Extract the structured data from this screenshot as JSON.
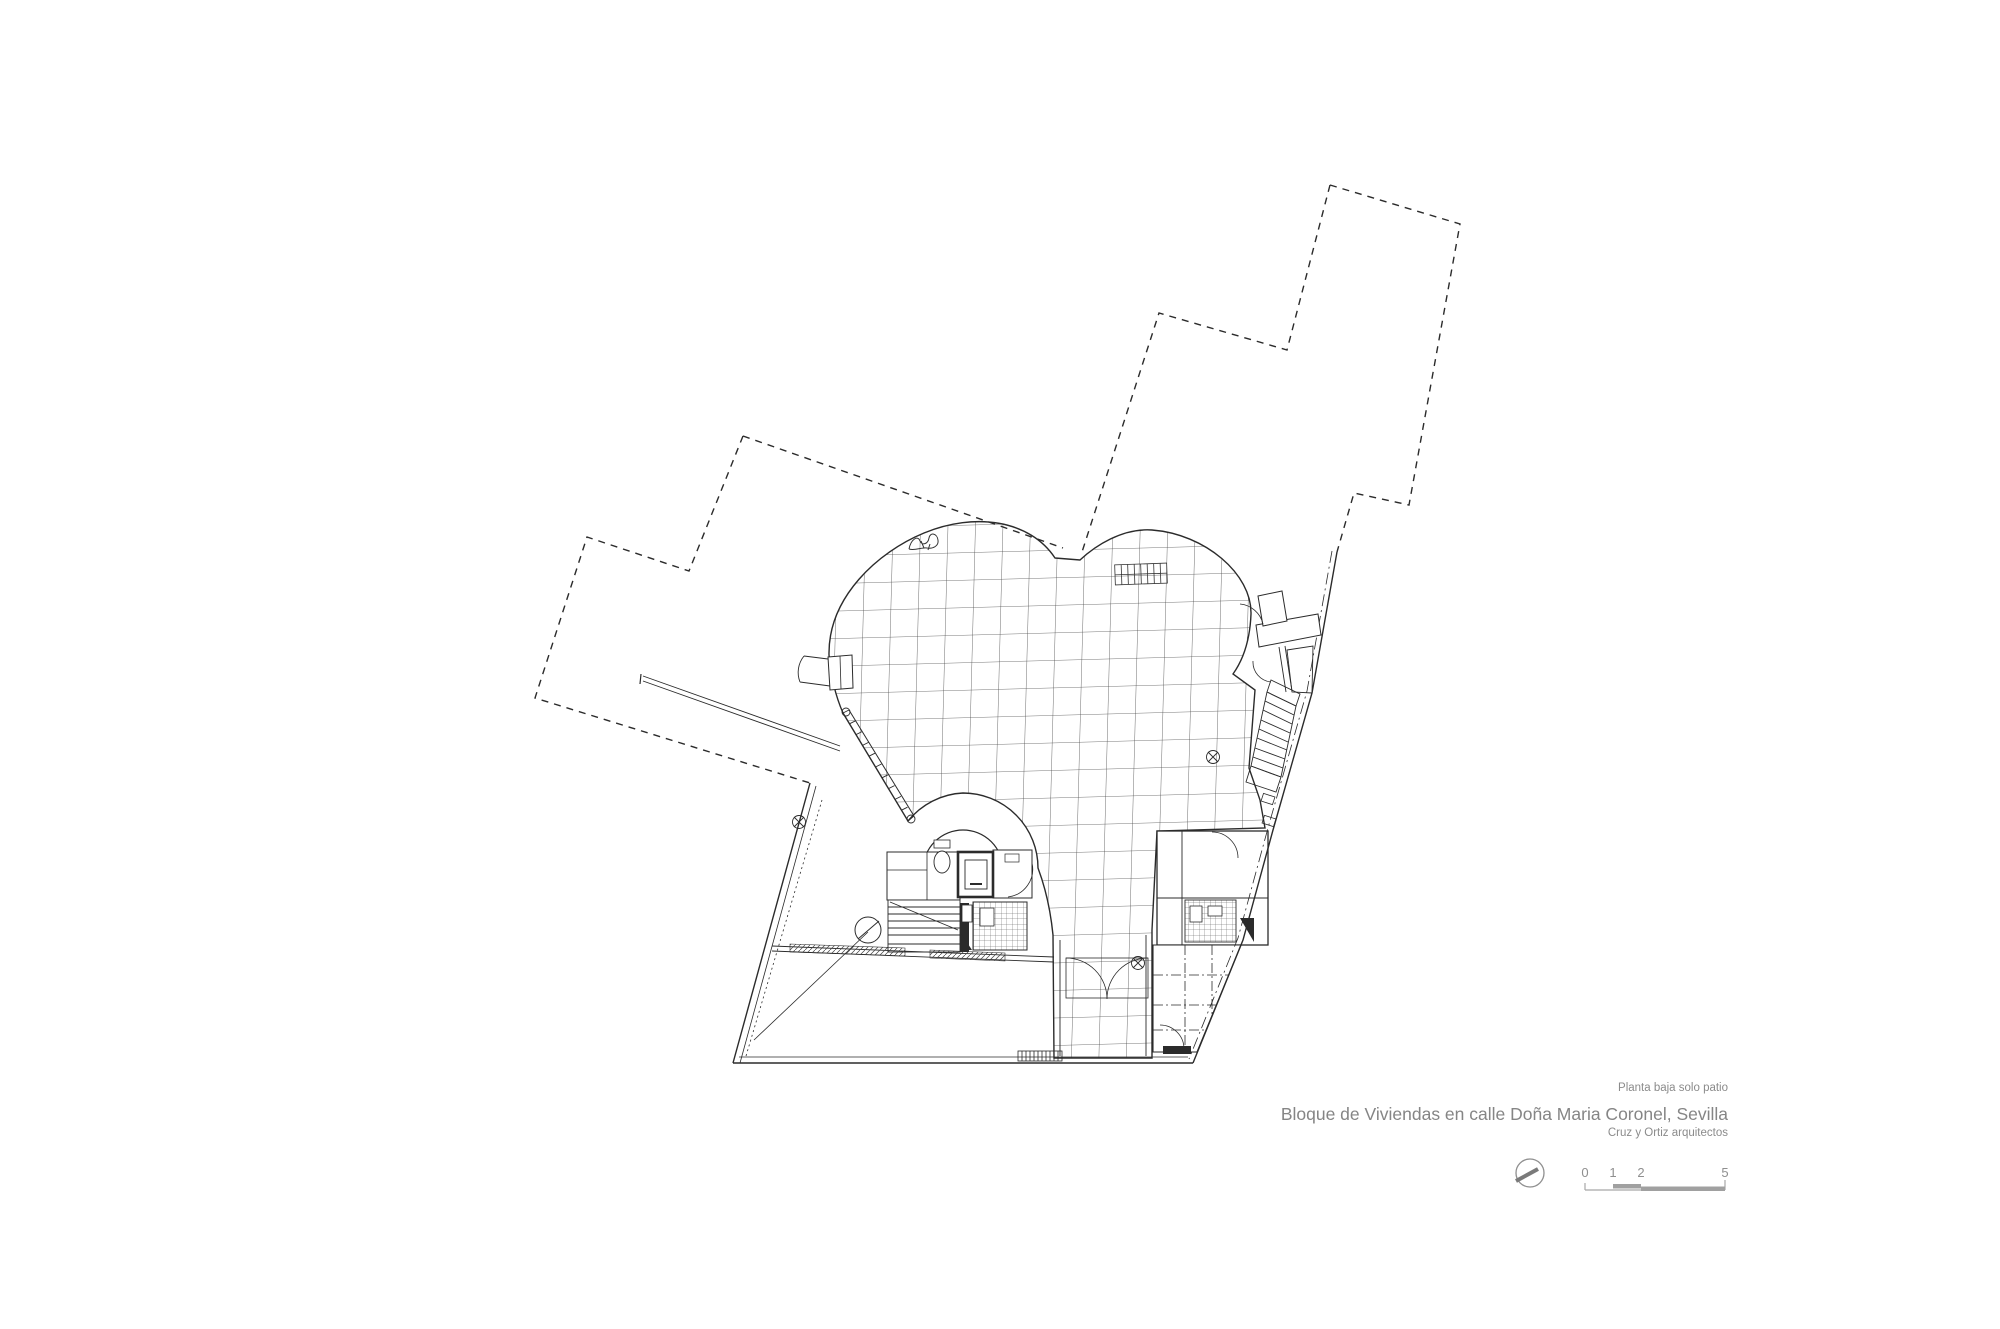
{
  "captions": {
    "plan_note": "Planta baja solo patio",
    "title": "Bloque de Viviendas en calle Doña Maria Coronel, Sevilla",
    "architects": "Cruz y Ortiz arquitectos"
  },
  "scale_bar": {
    "labels": [
      "0",
      "1",
      "2",
      "5"
    ]
  },
  "icons": {
    "north_arrow": "north-arrow-icon (circle with needle)"
  },
  "colors": {
    "paper": "#ffffff",
    "ink": "#2b2b2b",
    "grid_line": "#4a4a4a",
    "caption_text": "#8b8b8b",
    "scale_bar": "#a0a0a0"
  }
}
